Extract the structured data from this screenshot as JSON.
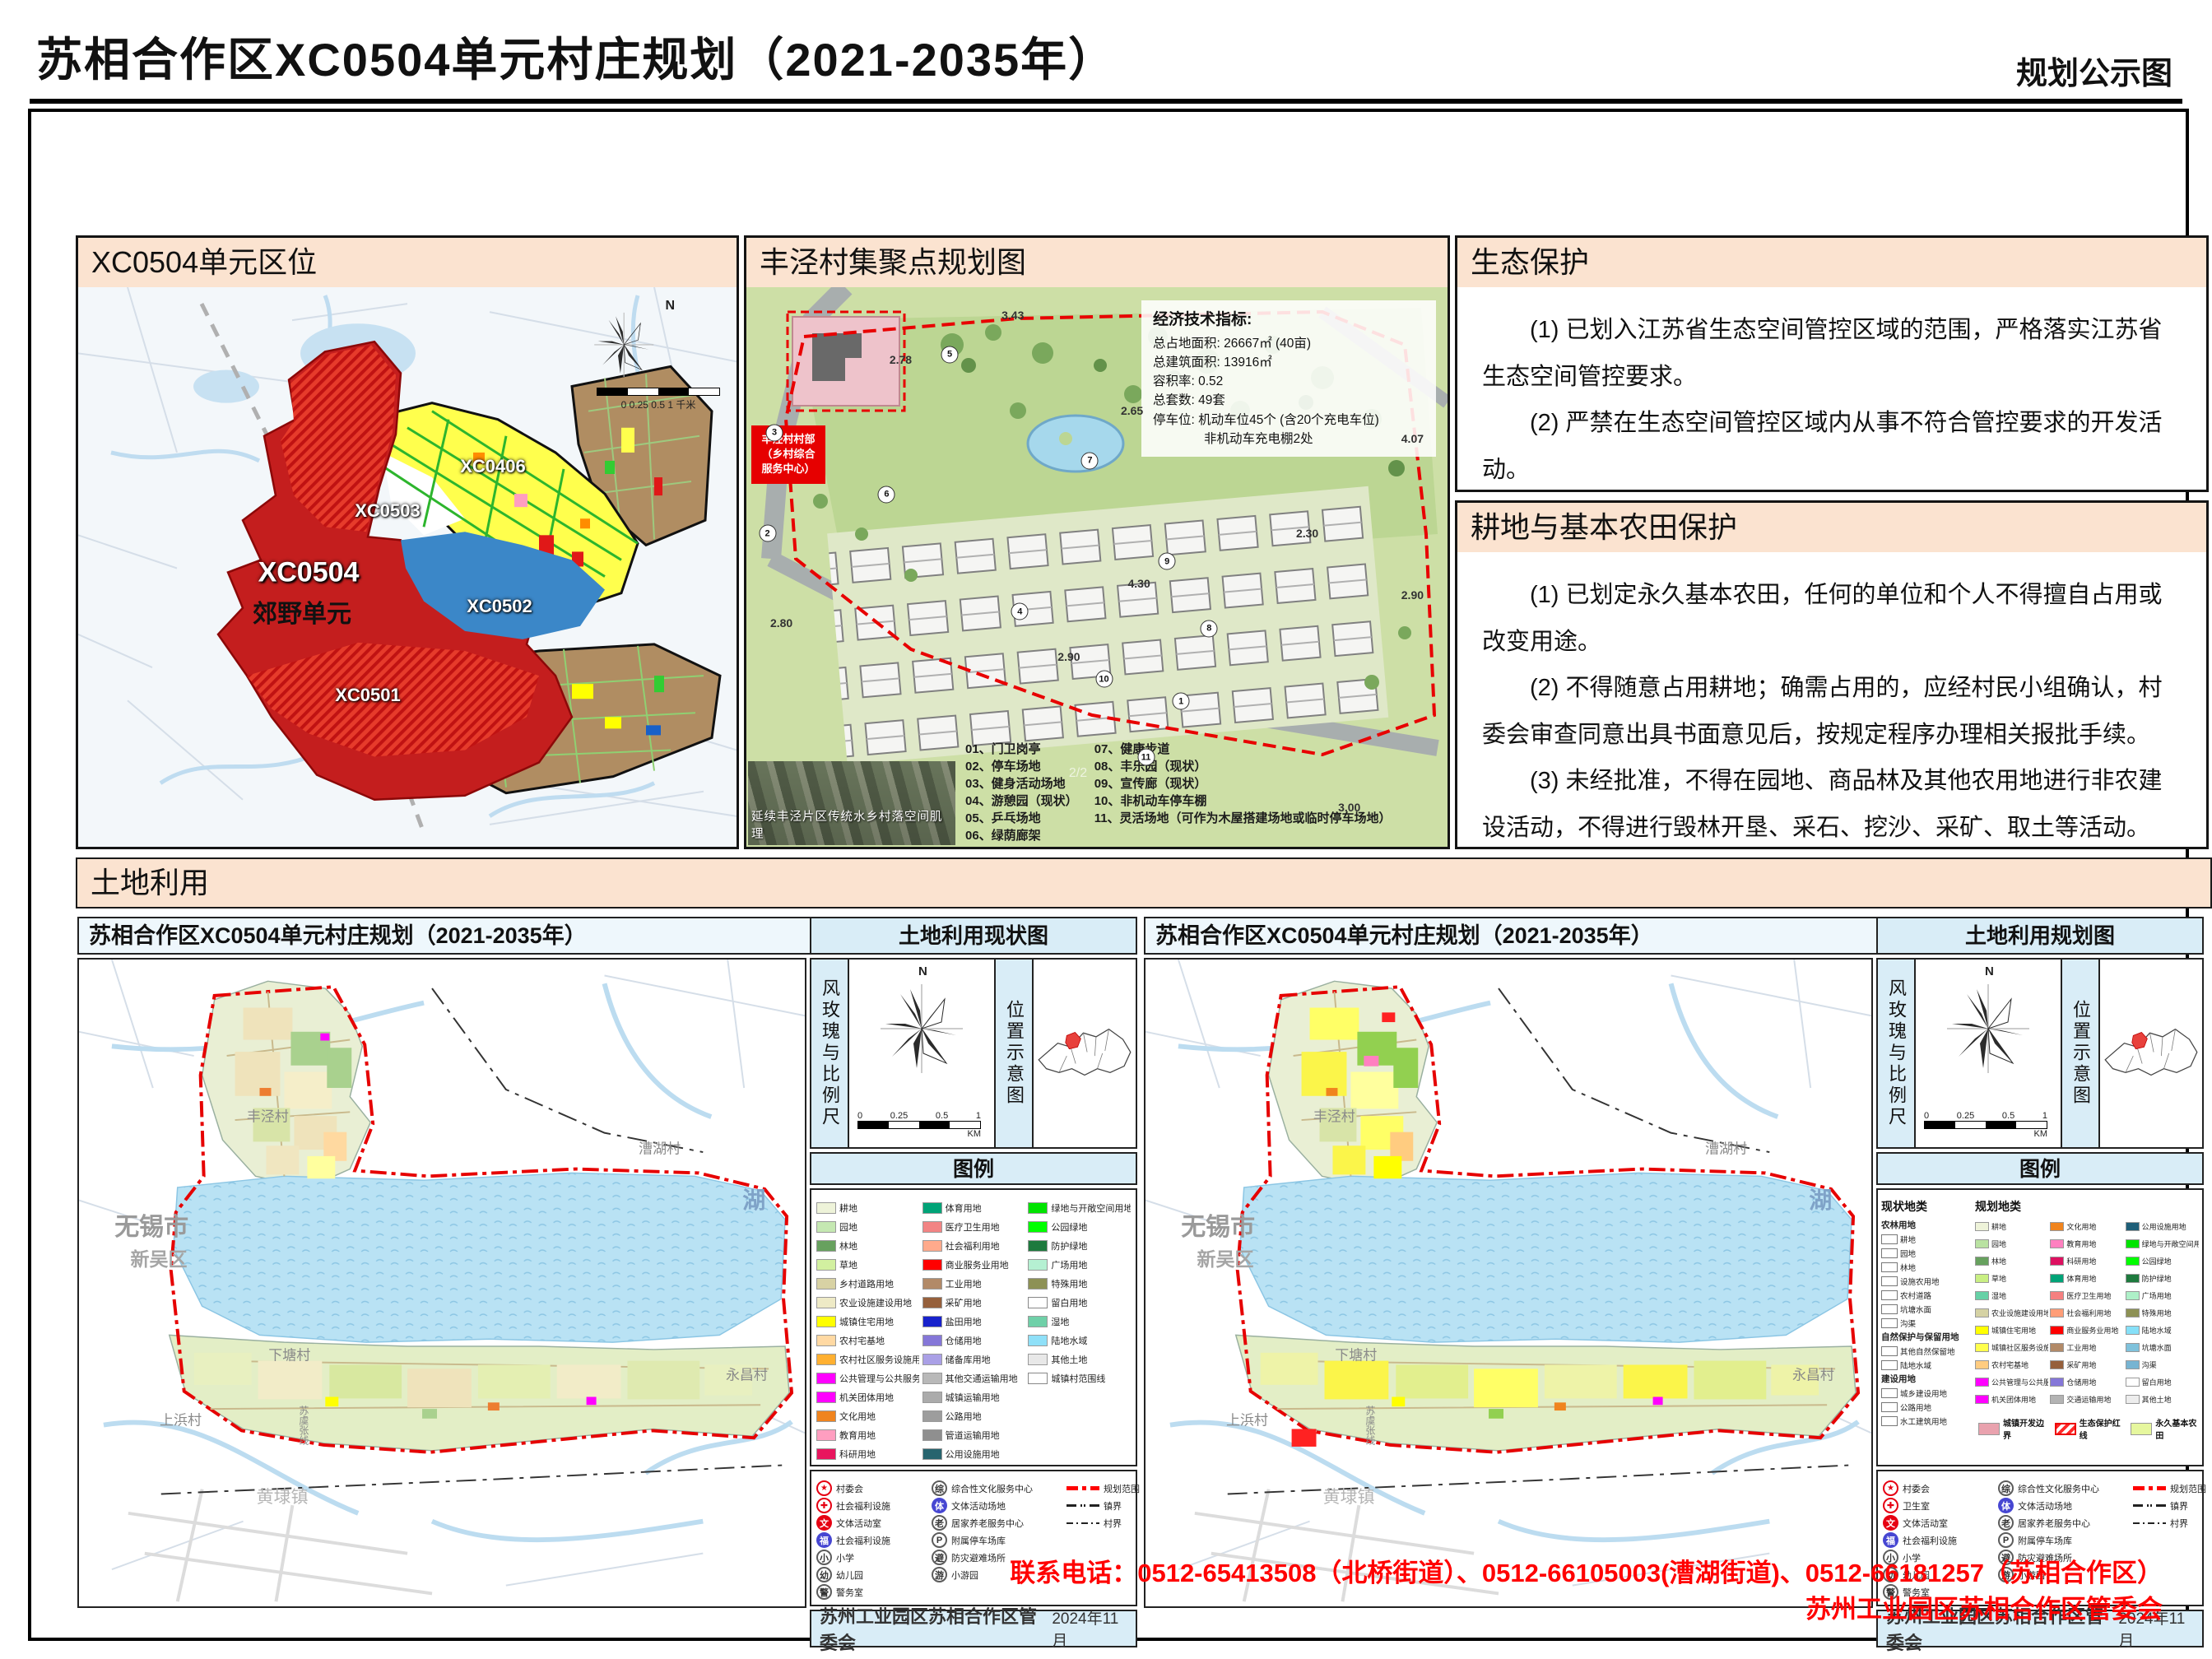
{
  "header": {
    "title": "苏相合作区XC0504单元村庄规划（2021-2035年）",
    "corner": "规划公示图"
  },
  "colors": {
    "panel_header_peach": "#fbe3d0",
    "sidebar_blue": "#d9edf7",
    "contact_red": "#ff0000",
    "plan_boundary_red": "#e60000",
    "water_blue": "#aadcf2"
  },
  "location_panel": {
    "title": "XC0504单元区位",
    "north": "N",
    "scale_ticks": "0  0.25  0.5",
    "scale_end": "1",
    "scale_unit": "千米",
    "zone_labels": [
      {
        "t": "XC0503",
        "x": "47%",
        "y": "40%",
        "cls": "zl-white"
      },
      {
        "t": "XC0406",
        "x": "63%",
        "y": "32%",
        "cls": "zl-white"
      },
      {
        "t": "XC0504",
        "x": "35%",
        "y": "51%",
        "cls": "zl-big"
      },
      {
        "t": "郊野单元",
        "x": "34%",
        "y": "58%",
        "cls": "zl-black"
      },
      {
        "t": "XC0502",
        "x": "64%",
        "y": "57%",
        "cls": "zl-white"
      },
      {
        "t": "XC0501",
        "x": "44%",
        "y": "73%",
        "cls": "zl-white"
      }
    ]
  },
  "cluster_panel": {
    "title": "丰泾村集聚点规划图",
    "indicators": {
      "heading": "经济技术指标:",
      "lines": [
        "总占地面积: 26667㎡ (40亩)",
        "总建筑面积: 13916㎡",
        "容积率: 0.52",
        "总套数: 49套",
        "停车位: 机动车位45个 (含20个充电车位)",
        "　　　　非机动车充电棚2处"
      ]
    },
    "site_label_lines": [
      "丰泾村村部",
      "（乡村综合",
      "服务中心）"
    ],
    "photo_caption": "延续丰泾片区传统水乡村落空间肌理",
    "page_marker": "2/2",
    "legend_col1": [
      "01、门卫岗亭",
      "02、停车场地",
      "03、健身活动场地",
      "04、游憩园（现状）",
      "05、乒乓场地",
      "06、绿荫廊架"
    ],
    "legend_col2": [
      "07、健康步道",
      "08、丰乐园（现状）",
      "09、宣传廊（现状）",
      "10、非机动车停车棚",
      "11、灵活场地（可作为木屋搭建场地或临时停车场地）"
    ],
    "dims": [
      {
        "t": "3.43",
        "x": "38%",
        "y": "5%"
      },
      {
        "t": "2.78",
        "x": "22%",
        "y": "13%"
      },
      {
        "t": "2.65",
        "x": "55%",
        "y": "22%"
      },
      {
        "t": "4.07",
        "x": "95%",
        "y": "27%"
      },
      {
        "t": "2.30",
        "x": "80%",
        "y": "44%"
      },
      {
        "t": "2.90",
        "x": "95%",
        "y": "55%"
      },
      {
        "t": "2.80",
        "x": "5%",
        "y": "60%"
      },
      {
        "t": "4.30",
        "x": "56%",
        "y": "53%"
      },
      {
        "t": "2.90",
        "x": "46%",
        "y": "66%"
      },
      {
        "t": "3.00",
        "x": "86%",
        "y": "93%"
      }
    ],
    "plan_numbers": [
      {
        "n": "5",
        "x": "29%",
        "y": "12%"
      },
      {
        "n": "3",
        "x": "4%",
        "y": "26%"
      },
      {
        "n": "2",
        "x": "3%",
        "y": "44%"
      },
      {
        "n": "7",
        "x": "49%",
        "y": "31%"
      },
      {
        "n": "6",
        "x": "20%",
        "y": "37%"
      },
      {
        "n": "9",
        "x": "60%",
        "y": "49%"
      },
      {
        "n": "4",
        "x": "39%",
        "y": "58%"
      },
      {
        "n": "8",
        "x": "66%",
        "y": "61%"
      },
      {
        "n": "10",
        "x": "51%",
        "y": "70%"
      },
      {
        "n": "1",
        "x": "62%",
        "y": "74%"
      },
      {
        "n": "11",
        "x": "57%",
        "y": "84%"
      }
    ]
  },
  "eco_panel": {
    "title": "生态保护",
    "paragraphs": [
      "(1) 已划入江苏省生态空间管控区域的范围，严格落实江苏省生态空间管控要求。",
      "(2) 严禁在生态空间管控区域内从事不符合管控要求的开发活动。"
    ]
  },
  "farm_panel": {
    "title": "耕地与基本农田保护",
    "paragraphs": [
      "(1) 已划定永久基本农田，任何的单位和个人不得擅自占用或改变用途。",
      "(2) 不得随意占用耕地；确需占用的，应经村民小组确认，村委会审查同意出具书面意见后，按规定程序办理相关报批手续。",
      "(3) 未经批准，不得在园地、商品林及其他农用地进行非农建设活动，不得进行毁林开垦、采石、挖沙、采矿、取土等活动。"
    ]
  },
  "landuse": {
    "section_title": "土地利用",
    "legend_title": "图例",
    "compass_label": "风玫瑰与比例尺",
    "position_label": "位置示意图",
    "north": "N",
    "scale": {
      "t0": "0",
      "t1": "0.25",
      "t2": "0.5",
      "t3": "1",
      "unit": "KM"
    },
    "footer_org": "苏州工业园区苏相合作区管委会",
    "footer_date": "2024年11月",
    "maps": [
      {
        "map_title": "苏相合作区XC0504单元村庄规划（2021-2035年）",
        "side_title": "土地利用现状图",
        "fac1": [
          {
            "g": "★",
            "c": "fi-star",
            "label": "村委会"
          },
          {
            "g": "✚",
            "c": "fi-cross",
            "label": "社会福利设施"
          },
          {
            "g": "文",
            "c": "fi-red",
            "label": "文体活动室"
          },
          {
            "g": "福",
            "c": "fi-blue",
            "label": "社会福利设施"
          },
          {
            "g": "小",
            "c": "fi-ring",
            "label": "小学"
          },
          {
            "g": "幼",
            "c": "fi-ring",
            "label": "幼儿园"
          },
          {
            "g": "警",
            "c": "fi-ring",
            "label": "警务室"
          }
        ]
      },
      {
        "map_title": "苏相合作区XC0504单元村庄规划（2021-2035年）",
        "side_title": "土地利用规划图",
        "fac1": [
          {
            "g": "★",
            "c": "fi-star",
            "label": "村委会"
          },
          {
            "g": "✚",
            "c": "fi-cross",
            "label": "卫生室"
          },
          {
            "g": "文",
            "c": "fi-red",
            "label": "文体活动室"
          },
          {
            "g": "福",
            "c": "fi-blue",
            "label": "社会福利设施"
          },
          {
            "g": "小",
            "c": "fi-ring",
            "label": "小学"
          },
          {
            "g": "幼",
            "c": "fi-ring",
            "label": "幼儿园"
          },
          {
            "g": "警",
            "c": "fi-ring",
            "label": "警务室"
          }
        ]
      }
    ],
    "fac2": [
      {
        "g": "综",
        "c": "fi-ring",
        "label": "综合性文化服务中心"
      },
      {
        "g": "体",
        "c": "fi-blue",
        "label": "文体活动场地"
      },
      {
        "g": "老",
        "c": "fi-ring",
        "label": "居家养老服务中心"
      },
      {
        "g": "P",
        "c": "fi-ring",
        "label": "附属停车场库"
      },
      {
        "g": "避",
        "c": "fi-ring",
        "label": "防灾避难场所"
      },
      {
        "g": "游",
        "c": "fi-ring",
        "label": "小游园"
      }
    ],
    "fac_lines": [
      {
        "c": "ln-plan",
        "label": "规划范围"
      },
      {
        "c": "ln-town",
        "label": "镇界"
      },
      {
        "c": "ln-vill",
        "label": "村界"
      }
    ],
    "map_labels": [
      {
        "t": "丰泾村",
        "x": "26%",
        "y": "24%",
        "cls": "ml-vill"
      },
      {
        "t": "漕湖村",
        "x": "80%",
        "y": "29%",
        "cls": "ml-vill"
      },
      {
        "t": "无锡市",
        "x": "10%",
        "y": "41%",
        "cls": "ml-city"
      },
      {
        "t": "新吴区",
        "x": "11%",
        "y": "46%",
        "cls": "ml-dist"
      },
      {
        "t": "湖",
        "x": "93%",
        "y": "37%",
        "cls": "ml-lake"
      },
      {
        "t": "下塘村",
        "x": "29%",
        "y": "61%",
        "cls": "ml-vill"
      },
      {
        "t": "上浜村",
        "x": "14%",
        "y": "71%",
        "cls": "ml-vill"
      },
      {
        "t": "永昌村",
        "x": "92%",
        "y": "64%",
        "cls": "ml-vill"
      },
      {
        "t": "黄埭镇",
        "x": "28%",
        "y": "83%",
        "cls": "ml-town"
      },
      {
        "t": "苏虞张线",
        "x": "31%",
        "y": "72%",
        "cls": "ml-road"
      }
    ],
    "legend_current": {
      "col1": [
        {
          "label": "耕地",
          "color": "#eef3d9",
          "kind": "sol"
        },
        {
          "label": "园地",
          "color": "#c5e8b2",
          "kind": "sol"
        },
        {
          "label": "林地",
          "color": "#67a15e",
          "kind": "sol"
        },
        {
          "label": "草地",
          "color": "#d2f0a0",
          "kind": "sol"
        },
        {
          "label": "乡村道路用地",
          "color": "#d8d2a4",
          "kind": "sol"
        },
        {
          "label": "农业设施建设用地",
          "color": "#eeeac6",
          "kind": "sol"
        },
        {
          "label": "城镇住宅用地",
          "color": "#ffff00",
          "kind": "hx"
        },
        {
          "label": "农村宅基地",
          "color": "#ffd9a3",
          "kind": "hat"
        },
        {
          "label": "农村社区服务设施用地",
          "color": "#ffb031",
          "kind": "hat"
        },
        {
          "label": "公共管理与公共服务用地",
          "color": "#ff00ff",
          "kind": "sol"
        },
        {
          "label": "机关团体用地",
          "color": "#ff00ff",
          "kind": "sol"
        },
        {
          "label": "文化用地",
          "color": "#f0841e",
          "kind": "hat"
        },
        {
          "label": "教育用地",
          "color": "#ff9ec0",
          "kind": "hat"
        },
        {
          "label": "科研用地",
          "color": "#e8155e",
          "kind": "sol"
        }
      ],
      "col2": [
        {
          "label": "体育用地",
          "color": "#00a377",
          "kind": "sol"
        },
        {
          "label": "医疗卫生用地",
          "color": "#f28484",
          "kind": "hat"
        },
        {
          "label": "社会福利用地",
          "color": "#ffaa8c",
          "kind": "hat"
        },
        {
          "label": "商业服务业用地",
          "color": "#ff0000",
          "kind": "sol"
        },
        {
          "label": "工业用地",
          "color": "#b28a68",
          "kind": "hat"
        },
        {
          "label": "采矿用地",
          "color": "#96603c",
          "kind": "sol"
        },
        {
          "label": "盐田用地",
          "color": "#1822cc",
          "kind": "hat"
        },
        {
          "label": "仓储用地",
          "color": "#8577d8",
          "kind": "sol"
        },
        {
          "label": "储备库用地",
          "color": "#aaa0e6",
          "kind": "hat"
        },
        {
          "label": "其他交通运输用地",
          "color": "#b9b9b9",
          "kind": "sol"
        },
        {
          "label": "城镇运输用地",
          "color": "#ababab",
          "kind": "sol"
        },
        {
          "label": "公路用地",
          "color": "#9d9d9d",
          "kind": "sol"
        },
        {
          "label": "管道运输用地",
          "color": "#8f8f8f",
          "kind": "sol"
        },
        {
          "label": "公用设施用地",
          "color": "#27646e",
          "kind": "hat"
        }
      ],
      "col3": [
        {
          "label": "绿地与开敞空间用地",
          "color": "#00e400",
          "kind": "hat"
        },
        {
          "label": "公园绿地",
          "color": "#00ff00",
          "kind": "hat"
        },
        {
          "label": "防护绿地",
          "color": "#1e7a3e",
          "kind": "sol"
        },
        {
          "label": "广场用地",
          "color": "#b5f0d2",
          "kind": "hat"
        },
        {
          "label": "特殊用地",
          "color": "#8d9155",
          "kind": "sol"
        },
        {
          "label": "留白用地",
          "color": "#ffffff",
          "kind": "out"
        },
        {
          "label": "湿地",
          "color": "#6fd0a8",
          "kind": "sol"
        },
        {
          "label": "陆地水域",
          "color": "#8fe0f8",
          "kind": "sol"
        },
        {
          "label": "其他土地",
          "color": "#e8e8e8",
          "kind": "dot"
        },
        {
          "label": "城镇村范围线",
          "color": "#ffffff",
          "kind": "out"
        }
      ]
    },
    "legend_planned": {
      "current_heading": "现状地类",
      "planned_heading": "规划地类",
      "current_list": [
        {
          "k": "g",
          "label": "农林用地"
        },
        {
          "k": "i",
          "label": "耕地"
        },
        {
          "k": "i",
          "label": "园地"
        },
        {
          "k": "i",
          "label": "林地"
        },
        {
          "k": "i",
          "label": "设施农用地"
        },
        {
          "k": "i",
          "label": "农村道路"
        },
        {
          "k": "i",
          "label": "坑塘水面"
        },
        {
          "k": "i",
          "label": "沟渠"
        },
        {
          "k": "g",
          "label": "自然保护与保留用地"
        },
        {
          "k": "i",
          "label": "其他自然保留地"
        },
        {
          "k": "i",
          "label": "陆地水域"
        },
        {
          "k": "g",
          "label": "建设用地"
        },
        {
          "k": "i",
          "label": "城乡建设用地"
        },
        {
          "k": "i",
          "label": "公路用地"
        },
        {
          "k": "i",
          "label": "水工建筑用地"
        }
      ],
      "colA": [
        {
          "label": "耕地",
          "color": "#eef3d9",
          "kind": "sol"
        },
        {
          "label": "园地",
          "color": "#b9e2a2",
          "kind": "sol"
        },
        {
          "label": "林地",
          "color": "#67a15e",
          "kind": "sol"
        },
        {
          "label": "草地",
          "color": "#c9ef83",
          "kind": "sol"
        },
        {
          "label": "湿地",
          "color": "#66d1a6",
          "kind": "sol"
        },
        {
          "label": "农业设施建设用地",
          "color": "#d5d2a4",
          "kind": "sol"
        },
        {
          "label": "城镇住宅用地",
          "color": "#ffff00",
          "kind": "sol"
        },
        {
          "label": "城镇社区服务设施用地",
          "color": "#ffff4d",
          "kind": "sol"
        },
        {
          "label": "农村宅基地",
          "color": "#ffcc80",
          "kind": "sol"
        },
        {
          "label": "公共管理与公共服务用地",
          "color": "#ff00ff",
          "kind": "sol"
        },
        {
          "label": "机关团体用地",
          "color": "#ff00ff",
          "kind": "sol"
        }
      ],
      "colB": [
        {
          "label": "文化用地",
          "color": "#f0841e",
          "kind": "sol"
        },
        {
          "label": "教育用地",
          "color": "#ff80c0",
          "kind": "sol"
        },
        {
          "label": "科研用地",
          "color": "#dd1060",
          "kind": "sol"
        },
        {
          "label": "体育用地",
          "color": "#00a377",
          "kind": "sol"
        },
        {
          "label": "医疗卫生用地",
          "color": "#f58080",
          "kind": "sol"
        },
        {
          "label": "社会福利用地",
          "color": "#ff9e78",
          "kind": "sol"
        },
        {
          "label": "商业服务业用地",
          "color": "#ff0000",
          "kind": "sol"
        },
        {
          "label": "工业用地",
          "color": "#b28a68",
          "kind": "sol"
        },
        {
          "label": "采矿用地",
          "color": "#96603c",
          "kind": "sol"
        },
        {
          "label": "仓储用地",
          "color": "#8577d8",
          "kind": "sol"
        },
        {
          "label": "交通运输用地",
          "color": "#b3b3b3",
          "kind": "sol"
        }
      ],
      "colC": [
        {
          "label": "公用设施用地",
          "color": "#1f5f78",
          "kind": "sol"
        },
        {
          "label": "绿地与开敞空间用地",
          "color": "#00e400",
          "kind": "sol"
        },
        {
          "label": "公园绿地",
          "color": "#00ff00",
          "kind": "sol"
        },
        {
          "label": "防护绿地",
          "color": "#1e7a3e",
          "kind": "sol"
        },
        {
          "label": "广场用地",
          "color": "#aef0c8",
          "kind": "sol"
        },
        {
          "label": "特殊用地",
          "color": "#8d9155",
          "kind": "sol"
        },
        {
          "label": "陆地水域",
          "color": "#86e0f8",
          "kind": "sol"
        },
        {
          "label": "坑塘水面",
          "color": "#7fc2dc",
          "kind": "sol"
        },
        {
          "label": "沟渠",
          "color": "#77b4d2",
          "kind": "sol"
        },
        {
          "label": "留白用地",
          "color": "#ffffff",
          "kind": "out"
        },
        {
          "label": "其他土地",
          "color": "#ededed",
          "kind": "sol"
        }
      ],
      "overlays": [
        {
          "label": "城镇开发边界",
          "color": "#e9a2ae",
          "kind": "sol"
        },
        {
          "label": "生态保护红线",
          "color": "#ffffff",
          "kind": "rh"
        },
        {
          "label": "永久基本农田",
          "color": "#e6f79e",
          "kind": "sol"
        }
      ]
    }
  },
  "contact": {
    "line1": "联系电话：0512-65413508（北桥街道）、0512-66105003(漕湖街道)、0512-66181257（苏相合作区）",
    "line2": "苏州工业园区苏相合作区管委会"
  }
}
